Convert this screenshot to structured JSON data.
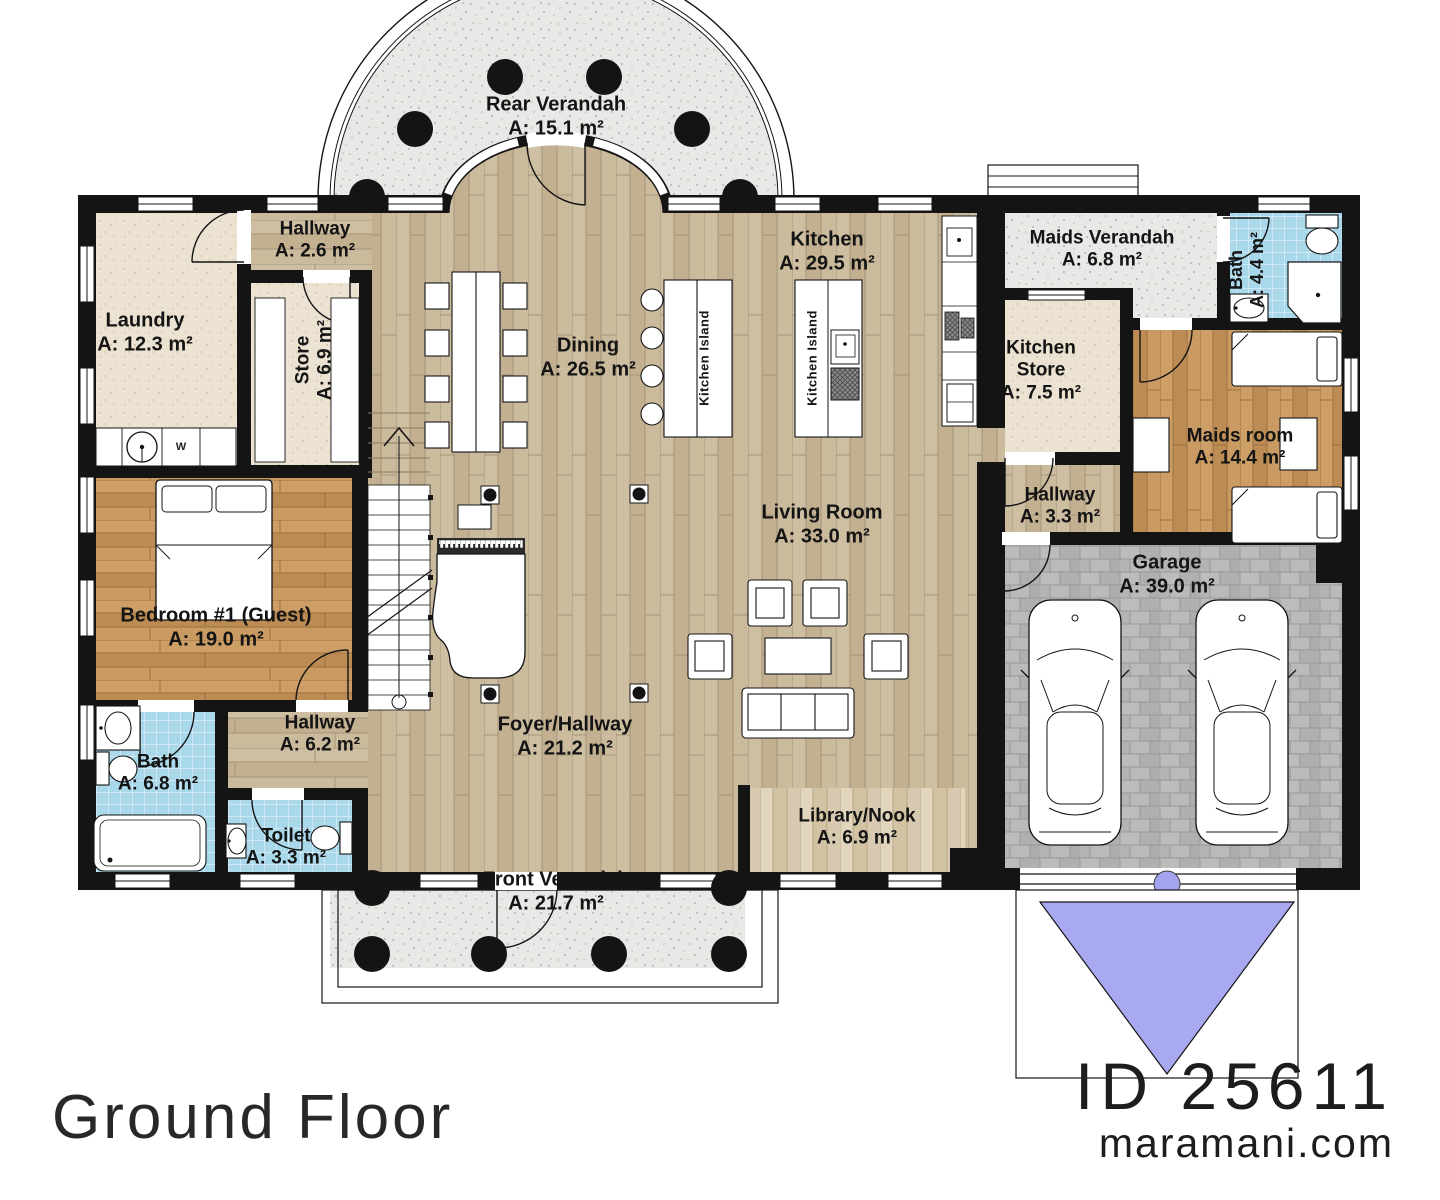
{
  "meta": {
    "floor_title": "Ground Floor",
    "plan_id": "ID 25611",
    "website": "maramani.com"
  },
  "rooms": {
    "rear_verandah": {
      "name": "Rear Verandah",
      "area": "A: 15.1 m²"
    },
    "hallway_top": {
      "name": "Hallway",
      "area": "A: 2.6 m²"
    },
    "laundry": {
      "name": "Laundry",
      "area": "A: 12.3 m²"
    },
    "store": {
      "name": "Store",
      "area": "A: 6.9 m²"
    },
    "dining": {
      "name": "Dining",
      "area": "A: 26.5 m²"
    },
    "kitchen": {
      "name": "Kitchen",
      "area": "A: 29.5 m²"
    },
    "maids_verandah": {
      "name": "Maids Verandah",
      "area": "A: 6.8 m²"
    },
    "maids_bath": {
      "name": "Bath",
      "area": "A: 4.4 m²"
    },
    "kitchen_store": {
      "name": "Kitchen Store",
      "area": "A: 7.5 m²"
    },
    "maids_room": {
      "name": "Maids room",
      "area": "A: 14.4 m²"
    },
    "hallway_right": {
      "name": "Hallway",
      "area": "A: 3.3 m²"
    },
    "living_room": {
      "name": "Living Room",
      "area": "A: 33.0 m²"
    },
    "garage": {
      "name": "Garage",
      "area": "A: 39.0 m²"
    },
    "bedroom1": {
      "name": "Bedroom #1 (Guest)",
      "area": "A: 19.0 m²"
    },
    "bath": {
      "name": "Bath",
      "area": "A: 6.8 m²"
    },
    "toilet": {
      "name": "Toilet",
      "area": "A: 3.3 m²"
    },
    "hallway_left": {
      "name": "Hallway",
      "area": "A: 6.2 m²"
    },
    "foyer": {
      "name": "Foyer/Hallway",
      "area": "A: 21.2 m²"
    },
    "library": {
      "name": "Library/Nook",
      "area": "A: 6.9 m²"
    },
    "front_verandah": {
      "name": "Front Verandah",
      "area": "A: 21.7 m²"
    }
  },
  "furniture_labels": {
    "kitchen_island_1": "Kitchen Island",
    "kitchen_island_2": "Kitchen Island",
    "washer": "W"
  },
  "colors": {
    "wall": "#141414",
    "wood_main": "#c8b698",
    "wood_orange": "#c6965e",
    "wood_light": "#dbcdb3",
    "beige": "#ebe2d1",
    "tile_blue": "#a8d8ea",
    "verandah_gray": "#e8e8e6",
    "paver_gray": "#b5b5b5",
    "driveway_purple": "#a9a9f1"
  }
}
